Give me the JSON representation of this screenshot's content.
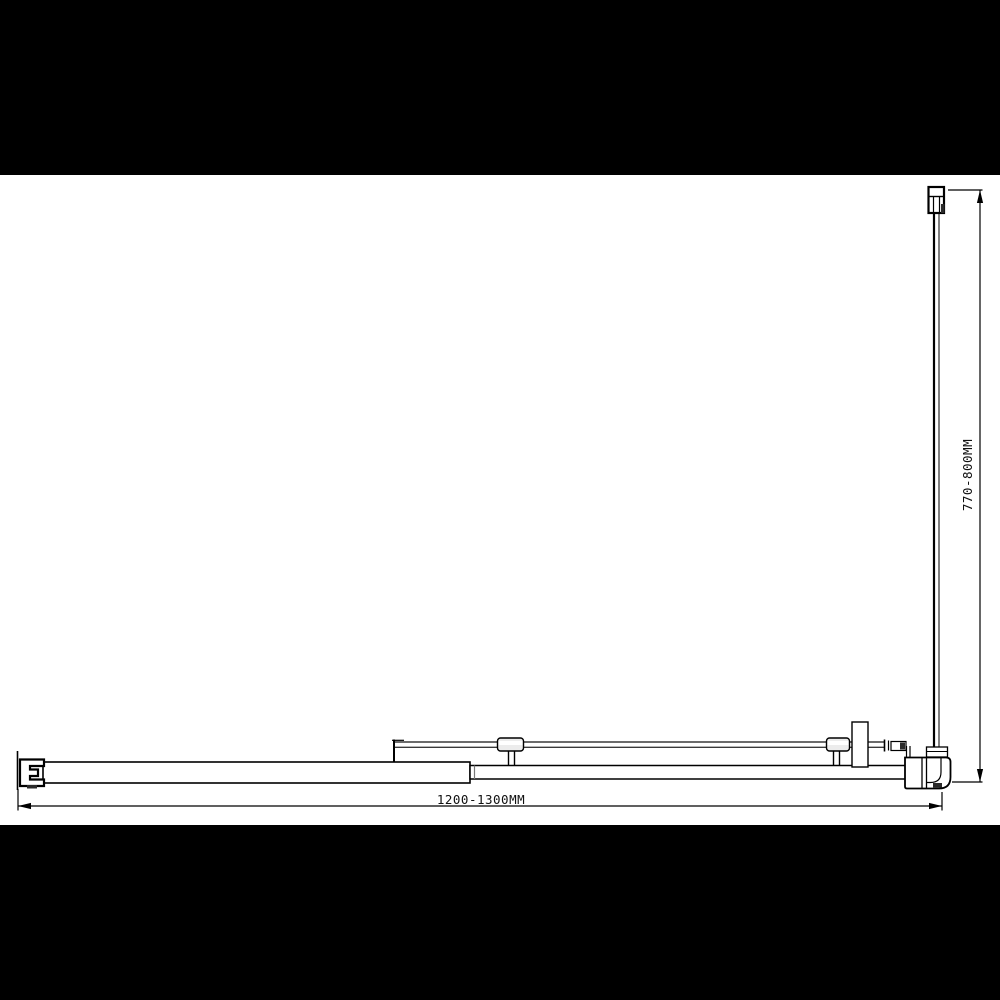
{
  "diagram": {
    "kind": "technical-drawing-plan-view",
    "subject": "corner shower enclosure with sliding door and return panel (top view)",
    "colors": {
      "background": "#000000",
      "paper": "#ffffff",
      "line": "#000000",
      "thin_line": "#3a3a3a",
      "bracket_fill": "#ececec",
      "dark_detail": "#2a2a2a"
    },
    "dimensions": {
      "width_label": "1200-1300MM",
      "depth_label": "770-800MM"
    },
    "parts": {
      "top_wall_bracket": "glass clamp bracket",
      "return_panel": "fixed return glass panel",
      "corner_post": "corner post with rounded outer corner",
      "wall_profile": "wall mounting profile",
      "fixed_panel_bar": "fixed panel (thick bar)",
      "sliding_panel_bar": "sliding door panel (thin bar)",
      "stabilizer_bar": "support / stabilizer bar",
      "support_bracket_1": "glass support bracket",
      "support_bracket_2": "glass support bracket",
      "handle_knob": "door knob / handle"
    }
  }
}
